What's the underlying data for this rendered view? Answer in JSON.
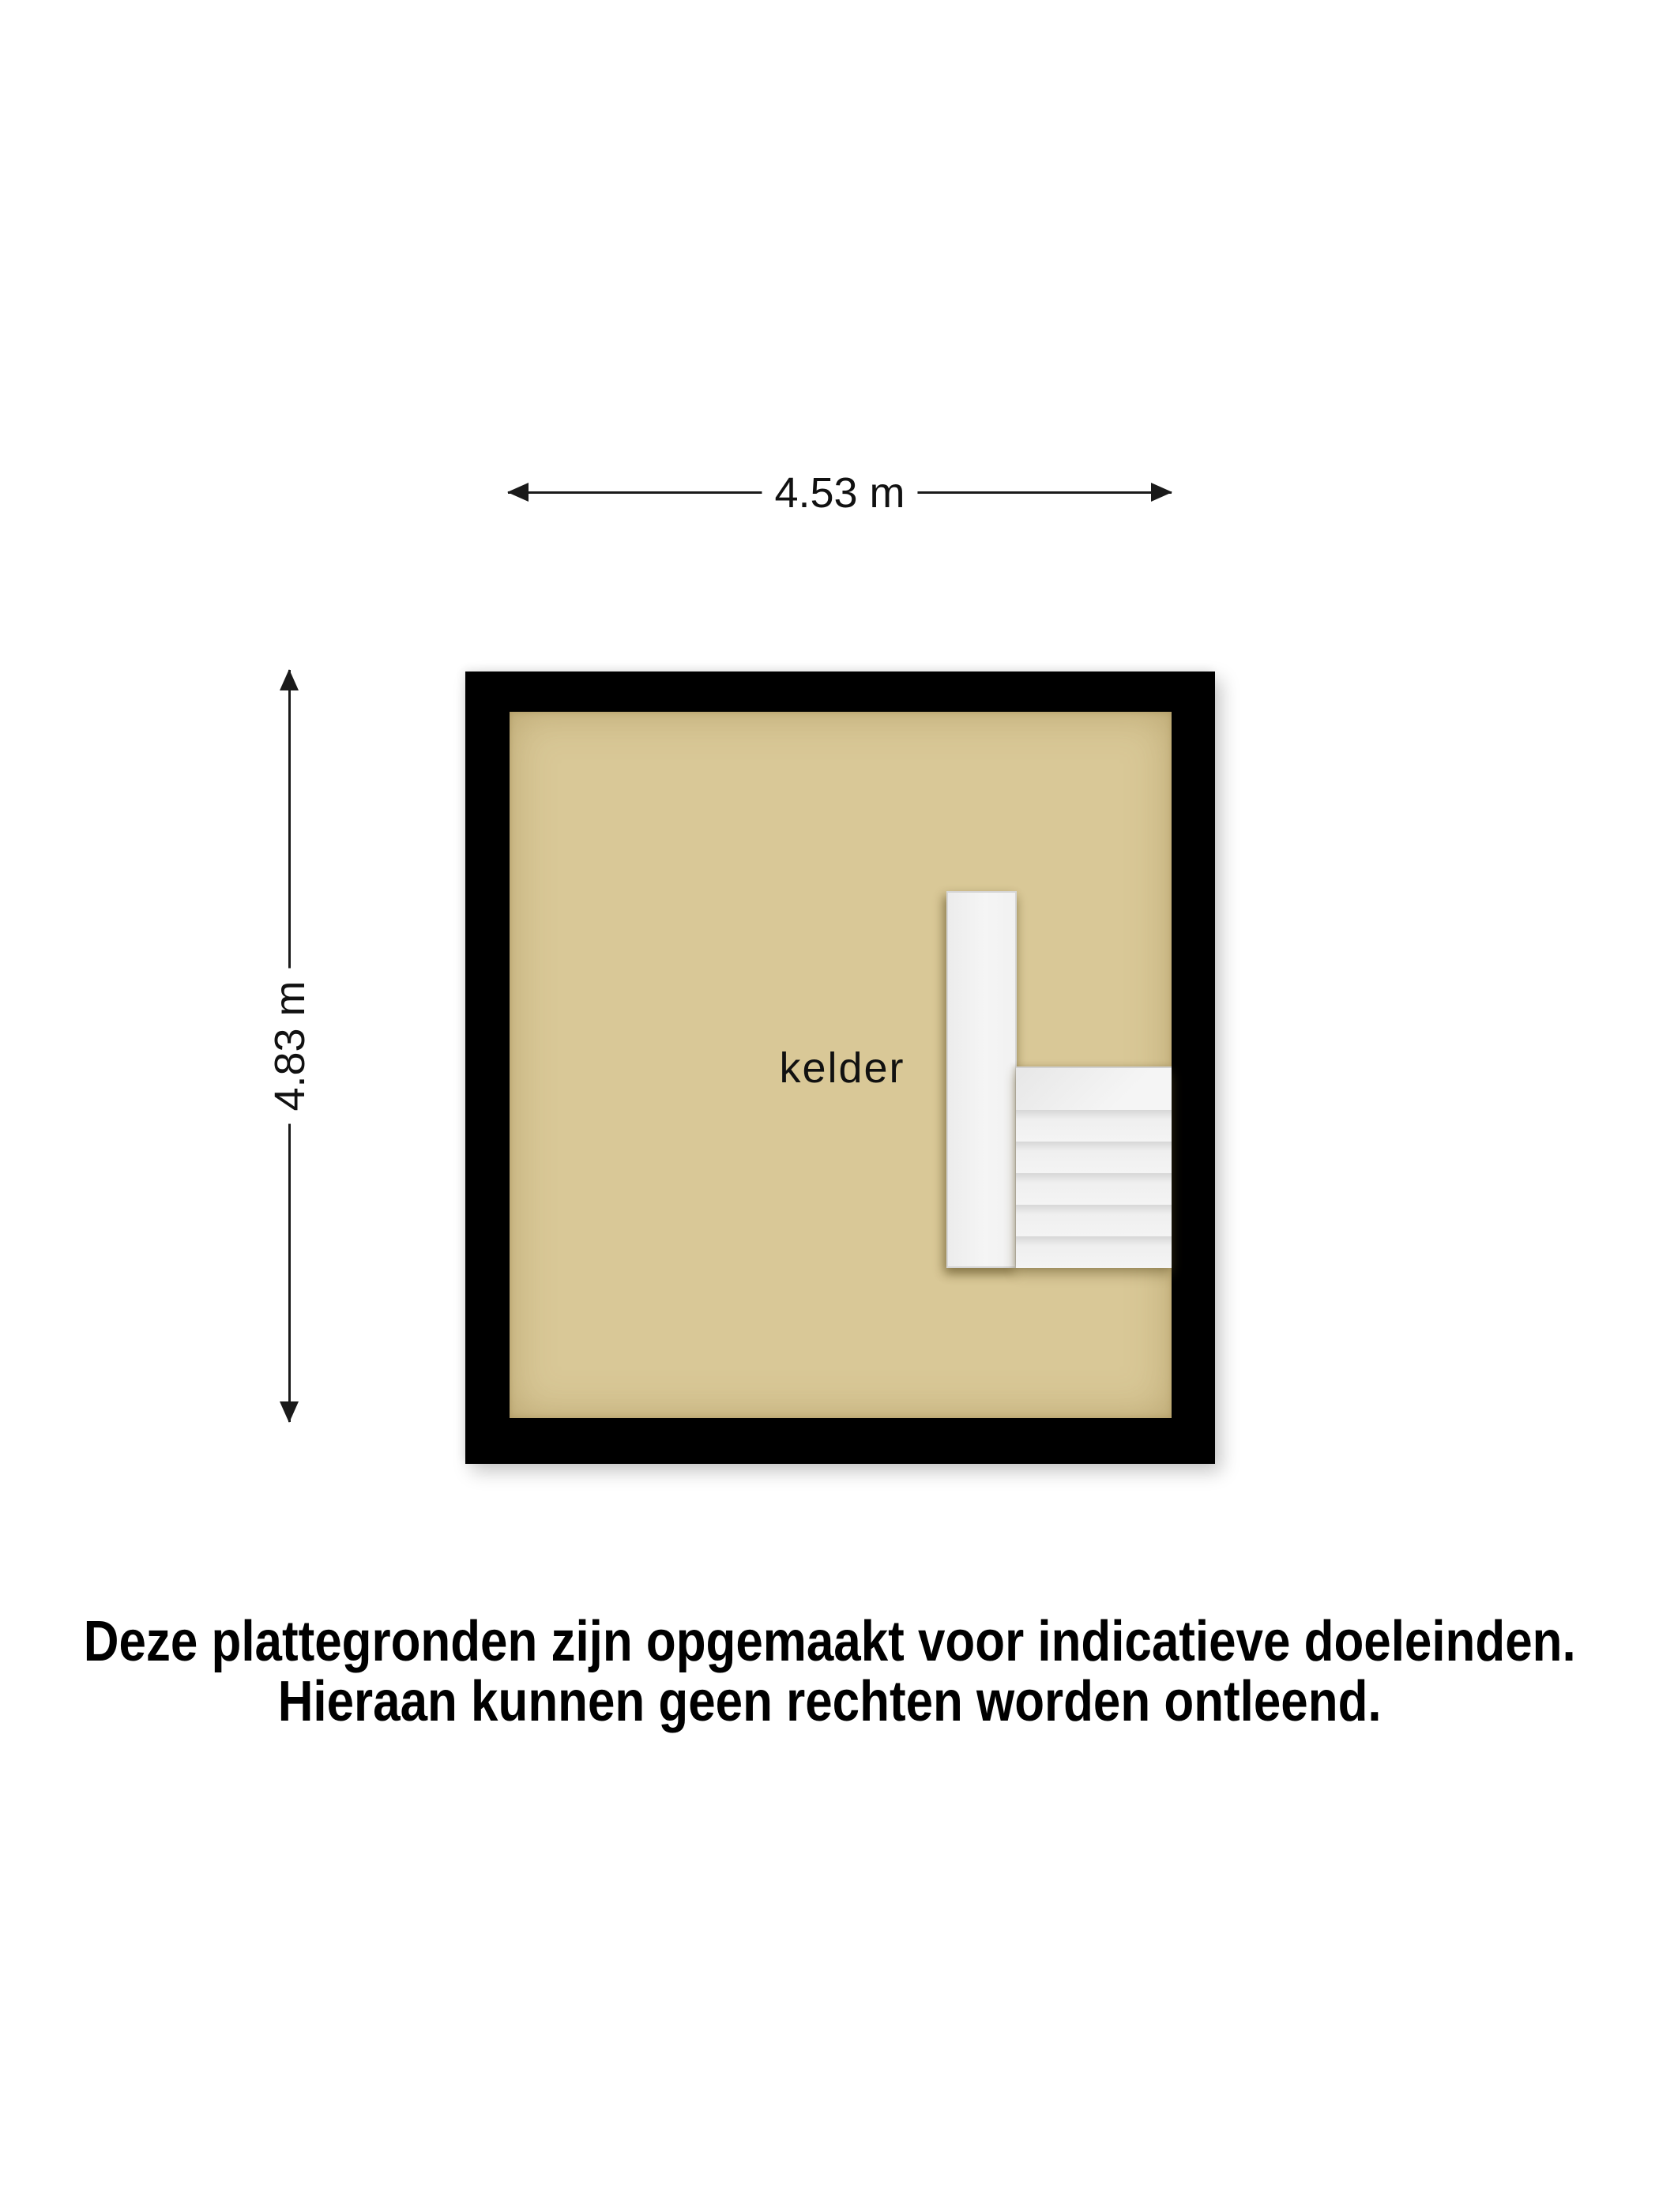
{
  "floorplan": {
    "room": {
      "label": "kelder"
    },
    "stairs": {
      "steps_after_landing": 5
    },
    "colors": {
      "wall": "#000000",
      "floor": "#d9c897",
      "stair_white": "#f2f2f2",
      "background": "#ffffff"
    }
  },
  "dimensions": {
    "width": {
      "label": "4.53 m"
    },
    "height": {
      "label": "4.83 m"
    }
  },
  "disclaimer": {
    "line1": "Deze plattegronden zijn opgemaakt voor indicatieve doeleinden.",
    "line2": "Hieraan kunnen geen rechten worden ontleend."
  }
}
